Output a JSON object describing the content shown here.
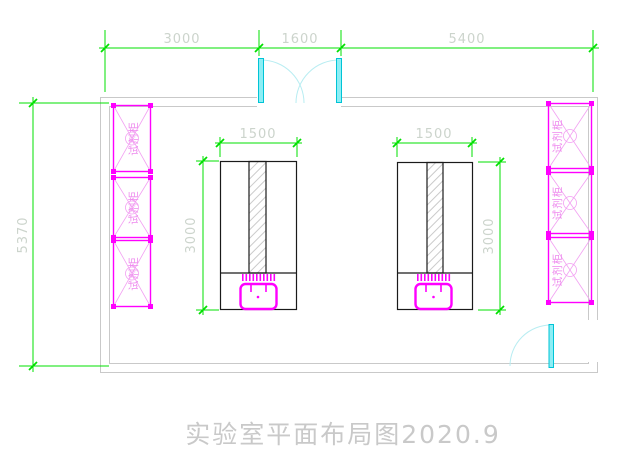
{
  "title": {
    "text": "实验室平面布局图2020.9"
  },
  "dims": {
    "top": [
      {
        "label": "3000"
      },
      {
        "label": "1600"
      },
      {
        "label": "5400"
      }
    ],
    "left": {
      "label": "5370"
    },
    "left_table": {
      "width": "1500",
      "height": "3000"
    },
    "right_table": {
      "width": "1500",
      "height": "3000"
    }
  },
  "cabinets": {
    "left": [
      {
        "label": "试剂柜"
      },
      {
        "label": "试剂柜"
      },
      {
        "label": "试剂柜"
      }
    ],
    "right": [
      {
        "label": "试剂柜"
      },
      {
        "label": "试剂柜"
      },
      {
        "label": "试剂柜"
      }
    ]
  },
  "colors": {
    "dimension": "#00e000",
    "dimension_text": "#ccd4cc",
    "wall": "#c9c9c9",
    "cabinet": "#ff00ff",
    "door": "#00c4d6",
    "title_text": "#c9c9c9"
  }
}
